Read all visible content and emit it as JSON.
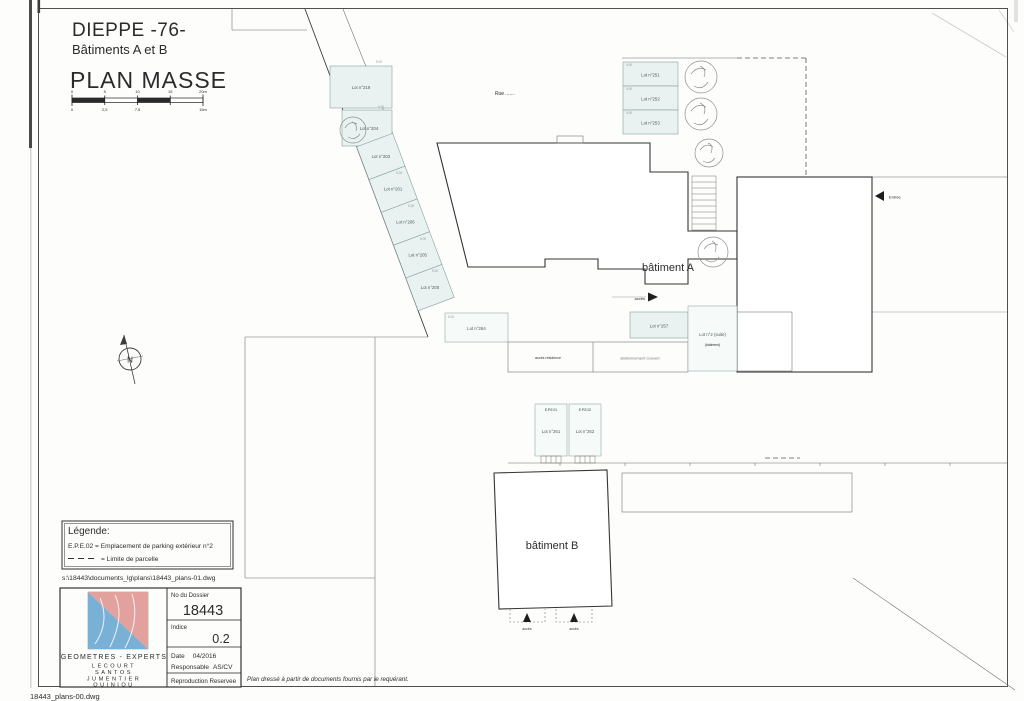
{
  "header": {
    "city": "DIEPPE -76-",
    "buildings": "Bâtiments A et B",
    "plan_title": "PLAN MASSE",
    "scale_top": [
      "0",
      "5",
      "10",
      "15",
      "20m"
    ],
    "scale_bottom": [
      "0",
      "2,5",
      "7,5",
      "15m"
    ]
  },
  "plan": {
    "street_label": "Rue .......",
    "building_a_label": "bâtiment A",
    "building_b_label": "bâtiment B",
    "lots_top_left": [
      "Lot n°219",
      "Lot n°204"
    ],
    "lots_diagonal": [
      "Lot n°203",
      "Lot n°201",
      "Lot n°206",
      "Lot n°205",
      "Lot n°200"
    ],
    "lots_top_right": [
      "Lot n°251",
      "Lot n°252",
      "Lot n°253"
    ],
    "lot_mid_left": "Lot n°264",
    "lot_mid_right": "Lot n°257",
    "lot_suite": "Lot n°2 (suite)",
    "lot_suite_sub": "(bâtiment)",
    "covered_parking_label": "stationnement couvert",
    "access_residence_label": "accès résidence",
    "entrance_a_label": "accès",
    "entrance_right_label": "Entrée",
    "entrance_b1_label": "accès",
    "entrance_b2_label": "accès",
    "epe_headers": [
      "E.P.E.01",
      "E.P.E.02"
    ],
    "epe_lots": [
      "Lot n°261",
      "Lot n°262"
    ],
    "north_letter": "N",
    "dim_label": "5.00"
  },
  "legend": {
    "title": "Légende:",
    "epe_line": "E.P.E.02 = Emplacement de parking extérieur n°2",
    "limit_line": "= Limite de parcelle"
  },
  "paths": {
    "source_file": "s:\\18443\\documents_lg\\plans\\18443_plans-01.dwg",
    "corner_file": "18443_plans-00.dwg"
  },
  "cartouche": {
    "firm": "GEOMETRES - EXPERTS",
    "names": [
      "LECOURT",
      "SANTOS",
      "JUMENTIER",
      "QUINIOU"
    ],
    "dossier_label": "No du Dossier",
    "dossier_value": "18443",
    "indice_label": "Indice",
    "indice_value": "0.2",
    "date_label": "Date",
    "date_value": "04/2016",
    "responsable_label": "Responsable",
    "responsable_value": "AS/CV",
    "reproduction": "Reproduction Reservee",
    "note": "Plan dressé à partir de documents fournis par le requérant."
  },
  "colors": {
    "parking_fill": "#e9f2f1",
    "line": "#3c3c3c",
    "accent_teal": "#45c2c6",
    "logo_blue": "#79b1d6",
    "logo_red": "#e2a19c"
  }
}
